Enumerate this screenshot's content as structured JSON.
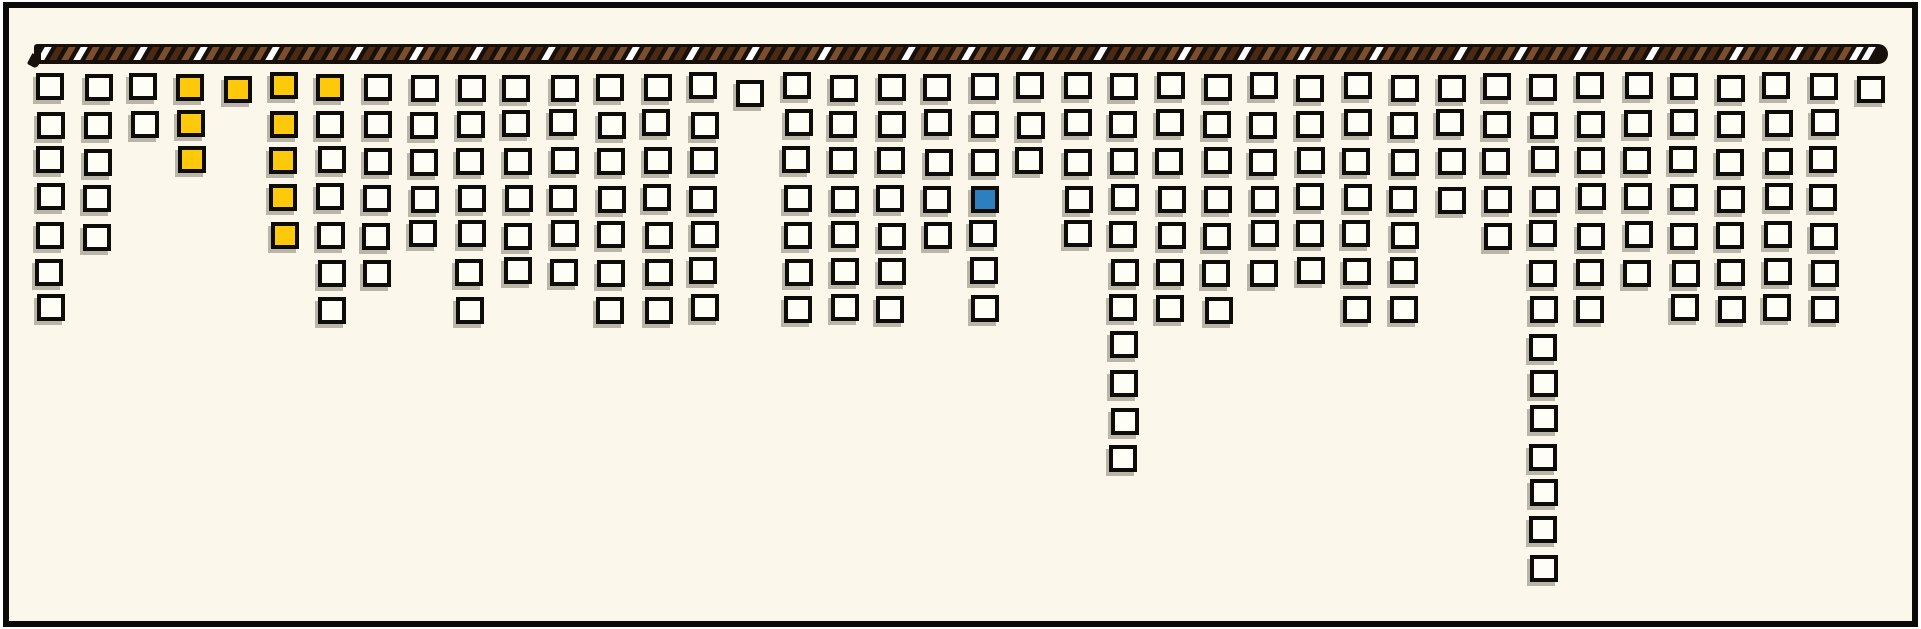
{
  "canvas": {
    "width": 1921,
    "height": 629,
    "outer_background": "#ffffff",
    "panel_fill": "#fbf8eb",
    "panel_border_color": "#0b0a08"
  },
  "rope": {
    "body_color": "#17100a",
    "stripe_brown_light": "#7d4e2e",
    "stripe_brown_dark": "#4b2a15",
    "stripe_white": "#ffffff"
  },
  "squares": {
    "fill_white": "#fffef6",
    "border_color": "#0d0c09",
    "shadow_color": "#b9b5a8",
    "fill_yellow": "#fec80b",
    "fill_blue": "#2e7fbd"
  },
  "chart_data": {
    "type": "bar",
    "subtype": "hanging-unit-square-pictograph",
    "title": "",
    "xlabel": "",
    "ylabel": "",
    "grid": "off",
    "legend": "none",
    "orientation": "columns hang downward from a striped rope at the top",
    "categories": [
      1,
      2,
      3,
      4,
      5,
      6,
      7,
      8,
      9,
      10,
      11,
      12,
      13,
      14,
      15,
      16,
      17,
      18,
      19,
      20,
      21,
      22,
      23,
      24,
      25,
      26,
      27,
      28,
      29,
      30,
      31,
      32,
      33,
      34,
      35,
      36,
      37,
      38,
      39,
      40
    ],
    "values": [
      7,
      5,
      2,
      3,
      1,
      5,
      7,
      6,
      5,
      7,
      6,
      6,
      7,
      7,
      7,
      1,
      7,
      7,
      7,
      5,
      7,
      3,
      5,
      11,
      7,
      7,
      6,
      6,
      7,
      7,
      4,
      5,
      14,
      7,
      6,
      7,
      7,
      7,
      7,
      1
    ],
    "value_range": [
      1,
      14
    ],
    "total_squares": 239,
    "highlights": [
      {
        "col": 4,
        "rows": [
          1,
          2,
          3
        ],
        "color": "yellow"
      },
      {
        "col": 5,
        "rows": [
          1
        ],
        "color": "yellow"
      },
      {
        "col": 6,
        "rows": [
          1,
          2,
          3,
          4,
          5
        ],
        "color": "yellow"
      },
      {
        "col": 7,
        "rows": [
          1
        ],
        "color": "yellow"
      },
      {
        "col": 21,
        "rows": [
          4
        ],
        "color": "blue"
      }
    ]
  }
}
